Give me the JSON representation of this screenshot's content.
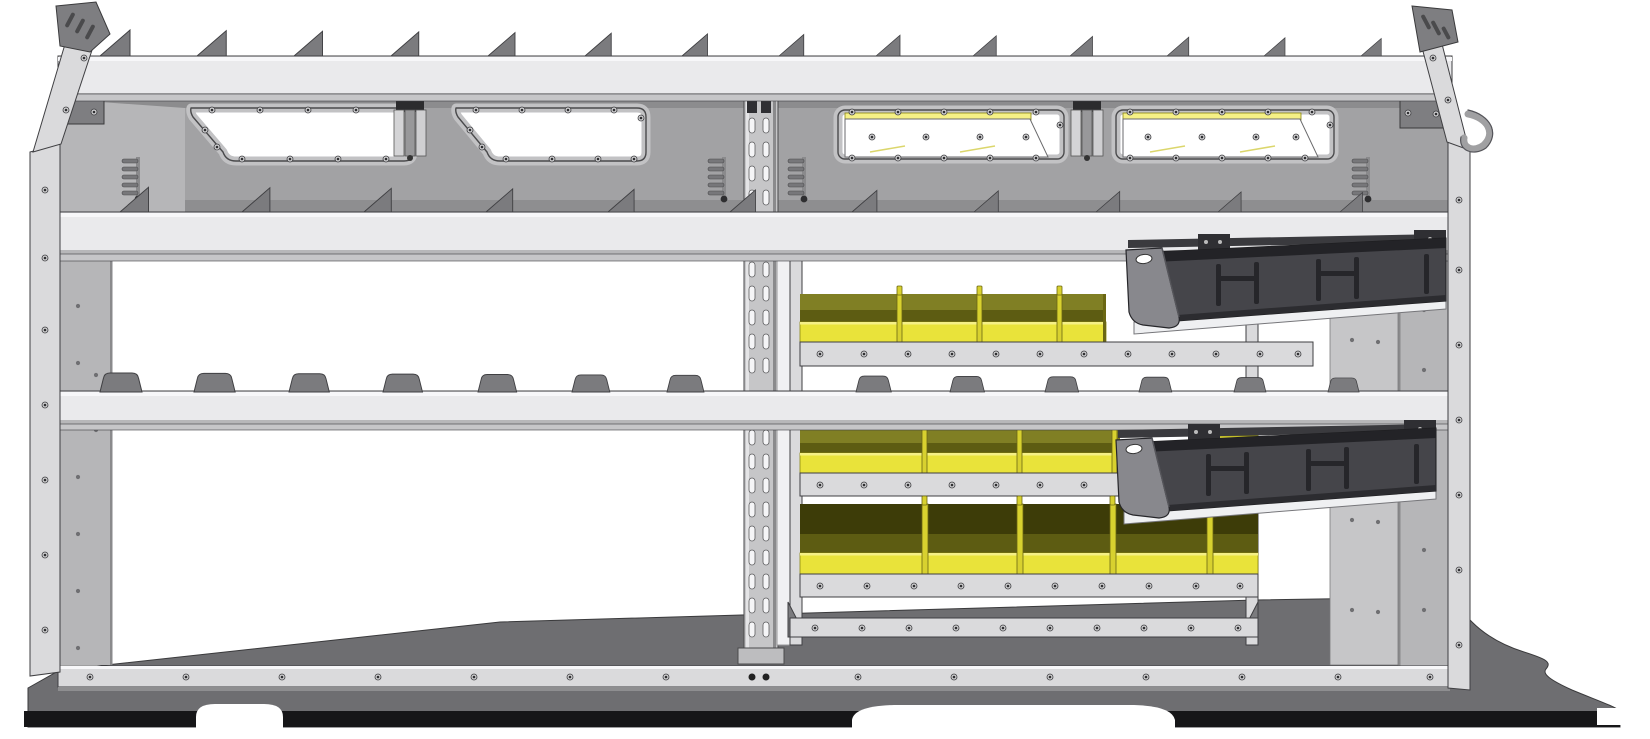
{
  "meta": {
    "name": "van-shelving-unit-side-view",
    "render_style": "CAD shaded product rendering on white background"
  },
  "colors": {
    "bg": "#ffffff",
    "metalBand": "#eaeaec",
    "metalBandTop": "#f7f7f9",
    "metalBandEdge": "#b7b7b9",
    "metalShade": "#c6c6c8",
    "metalRail": "#dadadc",
    "panelBack": "#a2a2a4",
    "panelWedge": "#b6b6b8",
    "panelSide": "#c6c6c8",
    "sidePanelWhite": "#f1f1f3",
    "finGray": "#7b7b7e",
    "edgeDark": "#3f3f42",
    "holeGray": "#6f6f72",
    "slotWhite": "#f5f5f7",
    "screwLight": "#cfcfd1",
    "screwDark": "#2f2f32",
    "binYellow": "#e9e33a",
    "binYellowLight": "#f5f086",
    "binOlive": "#807f24",
    "binOliveDark": "#5d5c12",
    "binInteriorDark": "#3d3c08",
    "dividerYellow": "#d8d12f",
    "drawerBody": "#45454a",
    "drawerTop": "#232327",
    "drawerCap": "#88888d",
    "drawerDetail": "#26262a",
    "slideWhite": "#eff0f2",
    "floorTop": "#6e6e71",
    "floorEdge": "#161618",
    "bracketDark": "#7e7e81",
    "frameGray": "#c2c2c4",
    "white": "#ffffff"
  },
  "structure": {
    "unit": {
      "type": "van shelving / racking unit",
      "view": "side elevation"
    },
    "top_shelf": {
      "divider_fins": 14
    },
    "upper_compartment": {
      "open_windows": 2,
      "covered_windows": 2,
      "clamp_mounts": 2,
      "ladder_hooks": 4
    },
    "middle_shelf": {
      "divider_fins": 11
    },
    "divider_block_row": {
      "blocks": 13
    },
    "bin_cabinet": {
      "rows": [
        {
          "name": "row-1",
          "bins_visible": 4,
          "color": "yellow"
        },
        {
          "name": "row-2",
          "bins_visible": 4,
          "color": "yellow"
        },
        {
          "name": "row-3",
          "bins_visible": 5,
          "color": "yellow"
        }
      ]
    },
    "drawers": [
      {
        "name": "drawer-1",
        "state": "open, tilted down"
      },
      {
        "name": "drawer-2",
        "state": "open, tilted down"
      }
    ],
    "perforated_upright": {
      "slot_columns": 2
    },
    "accessories": {
      "utility_hook": 1
    },
    "floor": {
      "cutouts": [
        "left arch",
        "center wheel arch",
        "right corner notch"
      ]
    }
  }
}
